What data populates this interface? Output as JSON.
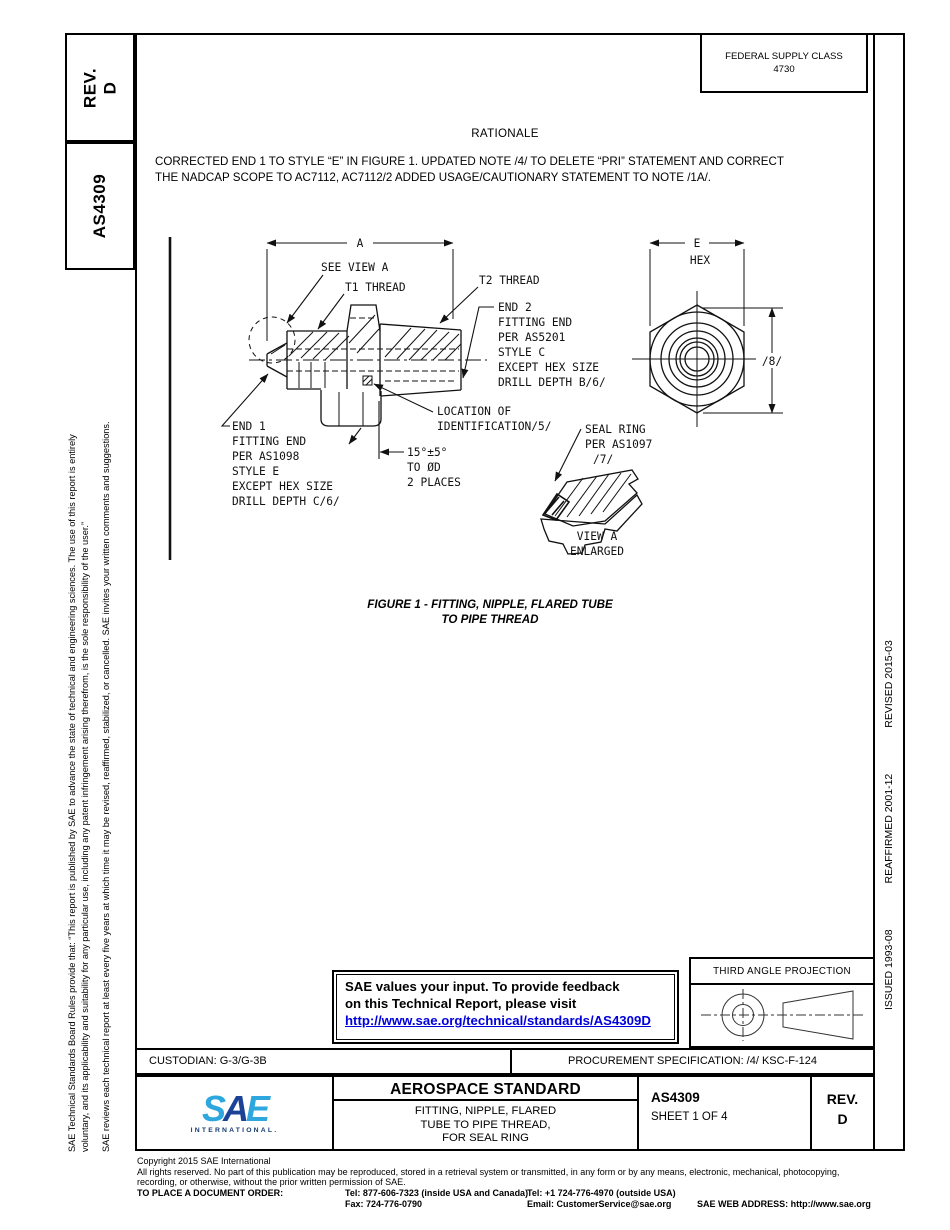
{
  "sidebar_left": {
    "rev_label": "REV.",
    "rev_value": "D",
    "doc_number": "AS4309",
    "disclaimer_line1": "SAE Technical Standards Board Rules provide that: “This report is published by SAE to advance the state of technical and engineering sciences. The use of this report is entirely",
    "disclaimer_line2": "voluntary, and its applicability and suitability for any particular use, including any patent infringement arising therefrom, is the sole responsibility of the user.”",
    "disclaimer_line3": "SAE reviews each technical report at least every five years at which time it may be revised, reaffirmed, stabilized, or cancelled. SAE invites your written comments and suggestions."
  },
  "sidebar_right": {
    "issued": "ISSUED 1993-08",
    "reaffirmed": "REAFFIRMED 2001-12",
    "revised": "REVISED 2015-03"
  },
  "header": {
    "federal_supply_class_label": "FEDERAL SUPPLY CLASS",
    "federal_supply_class_value": "4730"
  },
  "rationale": {
    "title": "RATIONALE",
    "body_line1": "CORRECTED END 1 TO STYLE “E” IN FIGURE 1. UPDATED NOTE /4/ TO DELETE “PRI” STATEMENT AND CORRECT",
    "body_line2": "THE NADCAP SCOPE TO AC7112, AC7112/2 ADDED USAGE/CAUTIONARY STATEMENT TO NOTE /1A/."
  },
  "figure": {
    "caption_line1": "FIGURE 1 - FITTING, NIPPLE, FLARED TUBE",
    "caption_line2": "TO PIPE THREAD",
    "labels": {
      "dim_a": "A",
      "see_view_a": "SEE VIEW A",
      "t1_thread": "T1 THREAD",
      "t2_thread": "T2 THREAD",
      "end2": [
        "END 2",
        "FITTING END",
        "PER AS5201",
        "STYLE C",
        "EXCEPT HEX SIZE",
        "DRILL DEPTH B/6/"
      ],
      "end1": [
        "END 1",
        "FITTING END",
        "PER AS1098",
        "STYLE E",
        "EXCEPT HEX SIZE",
        "DRILL DEPTH C/6/"
      ],
      "location_id": [
        "LOCATION OF",
        "IDENTIFICATION/5/"
      ],
      "angle_note": [
        "15°±5°",
        "TO ØD",
        "2 PLACES"
      ],
      "seal_ring": [
        "SEAL RING",
        "PER AS1097",
        "/7/"
      ],
      "view_a": [
        "VIEW A",
        "ENLARGED"
      ],
      "dim_e": "E",
      "hex_label": "HEX",
      "flag_8": "/8/"
    }
  },
  "feedback_box": {
    "line1": "SAE values your input. To provide feedback",
    "line2": "on this Technical Report, please visit",
    "link": "http://www.sae.org/technical/standards/AS4309D"
  },
  "projection_box": {
    "title": "THIRD ANGLE PROJECTION"
  },
  "custodian_row": {
    "custodian": "CUSTODIAN: G-3/G-3B",
    "procurement": "PROCUREMENT SPECIFICATION: /4/ KSC-F-124"
  },
  "title_block": {
    "logo_s": "S",
    "logo_a": "A",
    "logo_e": "E",
    "logo_sub": "INTERNATIONAL.",
    "standard_type": "AEROSPACE STANDARD",
    "title_line1": "FITTING, NIPPLE, FLARED",
    "title_line2": "TUBE TO PIPE THREAD,",
    "title_line3": "FOR SEAL RING",
    "doc_number": "AS4309",
    "sheet": "SHEET 1 OF 4",
    "rev_label": "REV.",
    "rev_value": "D"
  },
  "footer": {
    "copyright": "Copyright 2015 SAE International",
    "rights_line1": "All rights reserved. No part of this publication may be reproduced, stored in a retrieval system or transmitted, in any form or by any means, electronic, mechanical, photocopying,",
    "rights_line2": "recording, or otherwise, without the prior written permission of SAE.",
    "order_label": "TO PLACE A DOCUMENT ORDER:",
    "tel_inside": "Tel: 877-606-7323 (inside USA and Canada)",
    "tel_outside": "Tel: +1 724-776-4970 (outside USA)",
    "fax": "Fax: 724-776-0790",
    "email": "Email: CustomerService@sae.org",
    "web": "SAE WEB ADDRESS: http://www.sae.org"
  },
  "colors": {
    "link_blue": "#0000dd",
    "sae_light_blue": "#2ea7de",
    "sae_dark_blue": "#1a4296"
  }
}
